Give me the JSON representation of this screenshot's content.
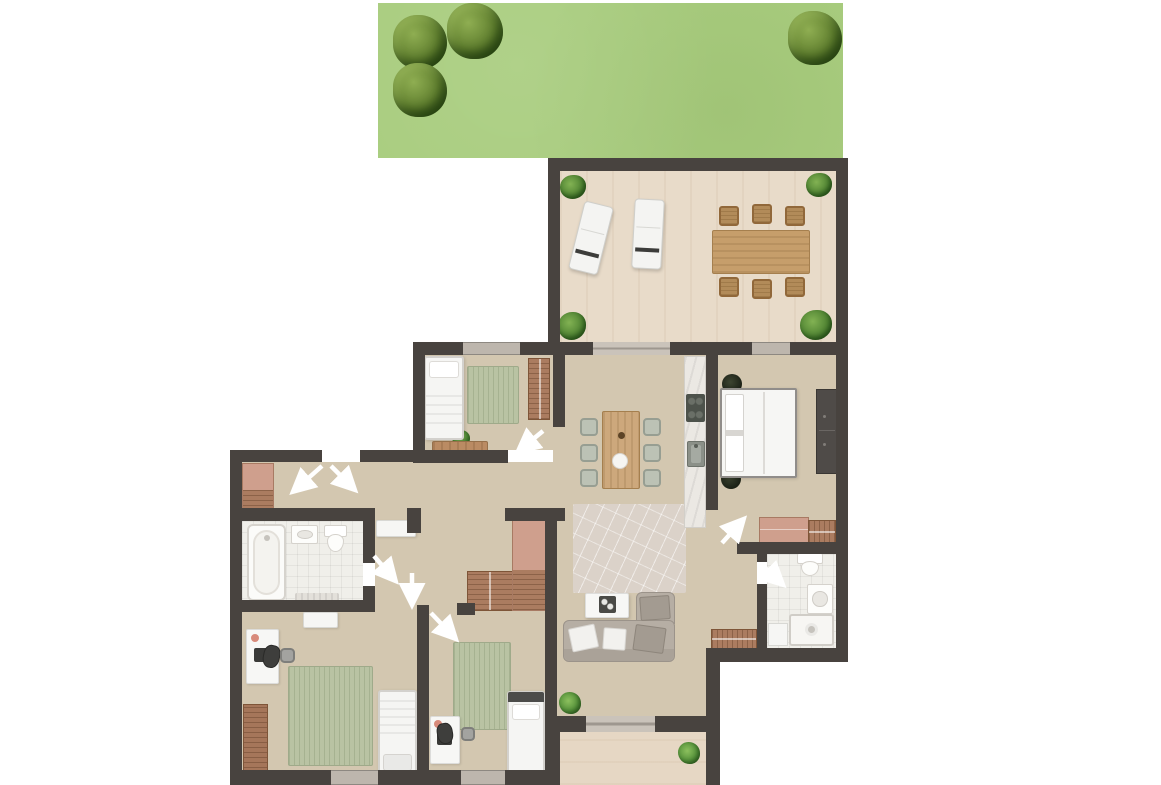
{
  "plan": {
    "canvas": {
      "w": 1161,
      "h": 785
    },
    "palette": {
      "wall": "#48433f",
      "garden_green": "#a9cd7f",
      "floor_wood": "#d3c7b0",
      "terrace_wood": "#e8dbc9",
      "entry_wood": "#e6d7c4",
      "bath_tile": "#f0efea",
      "window_gray": "#bdb6ad",
      "door_gray": "#cac3ba",
      "rug_green": "#b9c3a3",
      "closet_brown": "#ab7c60",
      "closet_salmon": "#cf9f8d",
      "sofa_gray": "#b6aea4",
      "arrow_white": "#ffffff"
    },
    "floors": [
      {
        "t": "garden",
        "n": "garden-lawn",
        "x": 378,
        "y": 3,
        "w": 465,
        "h": 155
      },
      {
        "t": "floor-terrace",
        "n": "terrace-floor",
        "x": 560,
        "y": 171,
        "w": 276,
        "h": 171
      },
      {
        "t": "floor-main",
        "n": "bedroom1-floor",
        "x": 425,
        "y": 355,
        "w": 128,
        "h": 95
      },
      {
        "t": "floor-main",
        "n": "hallway-floor",
        "x": 242,
        "y": 462,
        "w": 311,
        "h": 46
      },
      {
        "t": "floor-main",
        "n": "hall-center-floor",
        "x": 375,
        "y": 508,
        "w": 178,
        "h": 104
      },
      {
        "t": "floor-main",
        "n": "bedrooms-floor",
        "x": 242,
        "y": 612,
        "w": 303,
        "h": 158
      },
      {
        "t": "floor-main",
        "n": "living-floor",
        "x": 553,
        "y": 355,
        "w": 153,
        "h": 361
      },
      {
        "t": "floor-main",
        "n": "master-bedroom-floor",
        "x": 718,
        "y": 355,
        "w": 118,
        "h": 187
      },
      {
        "t": "floor-main",
        "n": "bath2-hall-floor",
        "x": 706,
        "y": 510,
        "w": 51,
        "h": 138
      },
      {
        "t": "floor-bath",
        "n": "bathroom1-floor",
        "x": 242,
        "y": 521,
        "w": 121,
        "h": 79
      },
      {
        "t": "floor-bath",
        "n": "bathroom2-floor",
        "x": 767,
        "y": 554,
        "w": 69,
        "h": 94
      },
      {
        "t": "floor-entry",
        "n": "entry-terrace-floor",
        "x": 560,
        "y": 732,
        "w": 146,
        "h": 53
      }
    ],
    "walls": [
      [
        548,
        158,
        300,
        13
      ],
      [
        548,
        158,
        12,
        197
      ],
      [
        836,
        158,
        12,
        504
      ],
      [
        413,
        342,
        50,
        13
      ],
      [
        520,
        342,
        73,
        13
      ],
      [
        670,
        342,
        82,
        13
      ],
      [
        790,
        342,
        58,
        13
      ],
      [
        413,
        342,
        12,
        115
      ],
      [
        230,
        450,
        92,
        12
      ],
      [
        360,
        450,
        65,
        12
      ],
      [
        230,
        450,
        12,
        335
      ],
      [
        230,
        770,
        101,
        15
      ],
      [
        378,
        770,
        83,
        15
      ],
      [
        505,
        770,
        52,
        15
      ],
      [
        706,
        648,
        142,
        14
      ],
      [
        706,
        648,
        14,
        137
      ],
      [
        548,
        716,
        38,
        16
      ],
      [
        655,
        716,
        57,
        16
      ],
      [
        548,
        716,
        12,
        69
      ],
      [
        553,
        342,
        12,
        85
      ],
      [
        413,
        450,
        95,
        13
      ],
      [
        230,
        508,
        141,
        13
      ],
      [
        505,
        508,
        60,
        13
      ],
      [
        407,
        508,
        14,
        25
      ],
      [
        363,
        508,
        12,
        55
      ],
      [
        363,
        586,
        12,
        26
      ],
      [
        230,
        600,
        145,
        12
      ],
      [
        417,
        605,
        12,
        165
      ],
      [
        457,
        603,
        18,
        12
      ],
      [
        545,
        508,
        12,
        262
      ],
      [
        706,
        342,
        12,
        168
      ],
      [
        737,
        542,
        111,
        12
      ],
      [
        757,
        554,
        10,
        8
      ],
      [
        757,
        584,
        10,
        64
      ]
    ],
    "openings": [
      {
        "t": "window",
        "n": "bedroom1-window",
        "x": 463,
        "y": 342,
        "w": 57,
        "h": 13
      },
      {
        "t": "slider",
        "n": "terrace-sliding-door",
        "x": 593,
        "y": 342,
        "w": 77,
        "h": 13
      },
      {
        "t": "window",
        "n": "master-bedroom-window",
        "x": 752,
        "y": 342,
        "w": 38,
        "h": 13
      },
      {
        "t": "window",
        "n": "bedroom2-window",
        "x": 331,
        "y": 770,
        "w": 47,
        "h": 15
      },
      {
        "t": "window",
        "n": "bedroom3-window",
        "x": 461,
        "y": 770,
        "w": 44,
        "h": 15
      },
      {
        "t": "slider",
        "n": "entry-sliding-door",
        "x": 586,
        "y": 716,
        "w": 69,
        "h": 16
      }
    ],
    "vegetation": [
      {
        "t": "tree",
        "n": "garden-tree",
        "x": 393,
        "y": 15,
        "w": 54,
        "h": 54
      },
      {
        "t": "tree",
        "n": "garden-tree",
        "x": 447,
        "y": 3,
        "w": 56,
        "h": 56
      },
      {
        "t": "tree",
        "n": "garden-tree",
        "x": 393,
        "y": 63,
        "w": 54,
        "h": 54
      },
      {
        "t": "tree",
        "n": "garden-tree",
        "x": 788,
        "y": 11,
        "w": 54,
        "h": 54
      },
      {
        "t": "shrub",
        "n": "terrace-corner-plant",
        "x": 560,
        "y": 175,
        "w": 26,
        "h": 24
      },
      {
        "t": "shrub",
        "n": "terrace-corner-plant",
        "x": 806,
        "y": 173,
        "w": 26,
        "h": 24
      },
      {
        "t": "shrub",
        "n": "terrace-corner-plant",
        "x": 558,
        "y": 312,
        "w": 28,
        "h": 28
      },
      {
        "t": "shrub",
        "n": "terrace-corner-plant",
        "x": 800,
        "y": 310,
        "w": 32,
        "h": 30
      },
      {
        "t": "plant",
        "n": "bench-plant",
        "x": 452,
        "y": 430,
        "w": 18,
        "h": 16
      },
      {
        "t": "plant",
        "n": "living-plant",
        "x": 559,
        "y": 692,
        "w": 22,
        "h": 22
      },
      {
        "t": "plant",
        "n": "entry-plant",
        "x": 678,
        "y": 742,
        "w": 22,
        "h": 22
      },
      {
        "t": "plant-dark",
        "n": "bedside-plant",
        "x": 722,
        "y": 374,
        "w": 20,
        "h": 20
      },
      {
        "t": "plant-dark",
        "n": "bedside-plant",
        "x": 721,
        "y": 469,
        "w": 20,
        "h": 20
      }
    ],
    "furniture": [
      {
        "t": "lounger",
        "n": "sun-lounger",
        "x": 576,
        "y": 203,
        "w": 30,
        "h": 70,
        "r": 14
      },
      {
        "t": "lounger",
        "n": "sun-lounger",
        "x": 633,
        "y": 199,
        "w": 30,
        "h": 70,
        "r": 3
      },
      {
        "t": "table-wood",
        "n": "terrace-dining-table",
        "x": 712,
        "y": 230,
        "w": 98,
        "h": 44
      },
      {
        "t": "chair-tan",
        "n": "terrace-chair",
        "x": 719,
        "y": 206,
        "w": 20,
        "h": 20
      },
      {
        "t": "chair-tan",
        "n": "terrace-chair",
        "x": 752,
        "y": 204,
        "w": 20,
        "h": 20
      },
      {
        "t": "chair-tan",
        "n": "terrace-chair",
        "x": 785,
        "y": 206,
        "w": 20,
        "h": 20
      },
      {
        "t": "chair-tan",
        "n": "terrace-chair",
        "x": 719,
        "y": 277,
        "w": 20,
        "h": 20
      },
      {
        "t": "chair-tan",
        "n": "terrace-chair",
        "x": 752,
        "y": 279,
        "w": 20,
        "h": 20
      },
      {
        "t": "chair-tan",
        "n": "terrace-chair",
        "x": 785,
        "y": 277,
        "w": 20,
        "h": 20
      },
      {
        "t": "rug-green",
        "n": "bedroom1-rug",
        "x": 467,
        "y": 366,
        "w": 52,
        "h": 58
      },
      {
        "t": "bed bed-n",
        "n": "bedroom1-bed",
        "x": 424,
        "y": 356,
        "w": 40,
        "h": 84
      },
      {
        "t": "closet-striped",
        "n": "bedroom1-wardrobe",
        "x": 528,
        "y": 358,
        "w": 22,
        "h": 62
      },
      {
        "t": "bench-wood",
        "n": "bedroom1-bench",
        "x": 432,
        "y": 441,
        "w": 56,
        "h": 12
      },
      {
        "t": "closet-combo",
        "n": "hallway-wardrobe",
        "x": 242,
        "y": 463,
        "w": 32,
        "h": 49
      },
      {
        "t": "closet-striped",
        "n": "hall-closet",
        "x": 467,
        "y": 571,
        "w": 46,
        "h": 40
      },
      {
        "t": "closet-combo",
        "n": "hall-closet-tall",
        "x": 512,
        "y": 518,
        "w": 40,
        "h": 93
      },
      {
        "t": "bathtub",
        "n": "bathtub",
        "x": 247,
        "y": 524,
        "w": 39,
        "h": 77
      },
      {
        "t": "sink-bath",
        "n": "bathroom1-sink",
        "x": 291,
        "y": 525,
        "w": 27,
        "h": 19
      },
      {
        "t": "toilet",
        "n": "bathroom1-toilet",
        "x": 324,
        "y": 525,
        "w": 23,
        "h": 27
      },
      {
        "t": "bath-mat",
        "n": "bath-mat",
        "x": 295,
        "y": 593,
        "w": 44,
        "h": 11
      },
      {
        "t": "bench-white",
        "n": "hall-bench",
        "x": 376,
        "y": 520,
        "w": 40,
        "h": 17
      },
      {
        "t": "bench-white",
        "n": "bedroom2-bench",
        "x": 303,
        "y": 612,
        "w": 35,
        "h": 16
      },
      {
        "t": "desk",
        "n": "bedroom2-desk",
        "x": 246,
        "y": 629,
        "w": 33,
        "h": 55
      },
      {
        "t": "chair-dark",
        "n": "bedroom2-desk-chair",
        "x": 263,
        "y": 645,
        "w": 17,
        "h": 23,
        "r": 12
      },
      {
        "t": "bin",
        "n": "bedroom2-bin",
        "x": 280,
        "y": 648,
        "w": 15,
        "h": 15
      },
      {
        "t": "rug-green",
        "n": "bedroom2-rug",
        "x": 288,
        "y": 666,
        "w": 85,
        "h": 100
      },
      {
        "t": "dresser-striped",
        "n": "bedroom2-dresser",
        "x": 243,
        "y": 704,
        "w": 25,
        "h": 70
      },
      {
        "t": "bed bed-s",
        "n": "bedroom2-bed",
        "x": 378,
        "y": 690,
        "w": 39,
        "h": 86
      },
      {
        "t": "rug-green",
        "n": "bedroom3-rug",
        "x": 453,
        "y": 642,
        "w": 58,
        "h": 88
      },
      {
        "t": "desk",
        "n": "bedroom3-desk",
        "x": 430,
        "y": 716,
        "w": 30,
        "h": 48
      },
      {
        "t": "chair-dark",
        "n": "bedroom3-desk-chair",
        "x": 437,
        "y": 723,
        "w": 16,
        "h": 21,
        "r": -10
      },
      {
        "t": "bin",
        "n": "bedroom3-bin",
        "x": 461,
        "y": 727,
        "w": 14,
        "h": 14
      },
      {
        "t": "bed bed-head",
        "n": "bedroom3-bed",
        "x": 507,
        "y": 691,
        "w": 38,
        "h": 86
      },
      {
        "t": "counter",
        "n": "kitchen-counter",
        "x": 684,
        "y": 356,
        "w": 22,
        "h": 172
      },
      {
        "t": "cooktop",
        "n": "cooktop",
        "x": 686,
        "y": 394,
        "w": 19,
        "h": 28
      },
      {
        "t": "sink-kitchen",
        "n": "kitchen-sink",
        "x": 687,
        "y": 441,
        "w": 18,
        "h": 26
      },
      {
        "t": "table-wood-v",
        "n": "dining-table",
        "x": 602,
        "y": 411,
        "w": 38,
        "h": 78
      },
      {
        "t": "chair-green",
        "n": "dining-chair",
        "x": 580,
        "y": 418,
        "w": 18,
        "h": 18
      },
      {
        "t": "chair-green",
        "n": "dining-chair",
        "x": 580,
        "y": 444,
        "w": 18,
        "h": 18
      },
      {
        "t": "chair-green",
        "n": "dining-chair",
        "x": 580,
        "y": 469,
        "w": 18,
        "h": 18
      },
      {
        "t": "chair-green",
        "n": "dining-chair",
        "x": 643,
        "y": 418,
        "w": 18,
        "h": 18
      },
      {
        "t": "chair-green",
        "n": "dining-chair",
        "x": 643,
        "y": 444,
        "w": 18,
        "h": 18
      },
      {
        "t": "chair-green",
        "n": "dining-chair",
        "x": 643,
        "y": 469,
        "w": 18,
        "h": 18
      },
      {
        "t": "rug-living",
        "n": "living-rug",
        "x": 573,
        "y": 504,
        "w": 113,
        "h": 89
      },
      {
        "t": "coffee-table",
        "n": "coffee-table",
        "x": 585,
        "y": 593,
        "w": 44,
        "h": 25
      },
      {
        "t": "tray",
        "n": "coffee-table-tray",
        "x": 599,
        "y": 596,
        "w": 17,
        "h": 17
      },
      {
        "t": "sofa-chaise",
        "n": "sofa-chaise",
        "x": 636,
        "y": 592,
        "w": 39,
        "h": 32
      },
      {
        "t": "sofa",
        "n": "sofa",
        "x": 563,
        "y": 620,
        "w": 112,
        "h": 42
      },
      {
        "t": "cushion-gray",
        "n": "sofa-cushion",
        "x": 640,
        "y": 596,
        "w": 30,
        "h": 24,
        "r": -4
      },
      {
        "t": "cushion-white",
        "n": "sofa-cushion",
        "x": 570,
        "y": 626,
        "w": 27,
        "h": 24,
        "r": -12
      },
      {
        "t": "cushion-white",
        "n": "sofa-cushion",
        "x": 603,
        "y": 628,
        "w": 23,
        "h": 22,
        "r": 4
      },
      {
        "t": "cushion-gray",
        "n": "sofa-cushion",
        "x": 634,
        "y": 626,
        "w": 31,
        "h": 26,
        "r": 8
      },
      {
        "t": "bed-double",
        "n": "master-bed",
        "x": 720,
        "y": 388,
        "w": 77,
        "h": 90
      },
      {
        "t": "wardrobe-dark",
        "n": "master-wardrobe",
        "x": 816,
        "y": 389,
        "w": 22,
        "h": 85
      },
      {
        "t": "dresser-salmon",
        "n": "master-dresser",
        "x": 759,
        "y": 517,
        "w": 50,
        "h": 26
      },
      {
        "t": "closet-striped-h",
        "n": "master-dresser-side",
        "x": 808,
        "y": 520,
        "w": 28,
        "h": 23
      },
      {
        "t": "closet-striped-h",
        "n": "hall-sideboard",
        "x": 711,
        "y": 629,
        "w": 46,
        "h": 20
      },
      {
        "t": "toilet",
        "n": "bathroom2-toilet",
        "x": 797,
        "y": 553,
        "w": 26,
        "h": 23
      },
      {
        "t": "sink-bath",
        "n": "bathroom2-sink",
        "x": 807,
        "y": 584,
        "w": 26,
        "h": 30
      },
      {
        "t": "shower",
        "n": "shower",
        "x": 789,
        "y": 614,
        "w": 45,
        "h": 32
      },
      {
        "t": "cabinet-white",
        "n": "bathroom2-cabinet",
        "x": 768,
        "y": 623,
        "w": 20,
        "h": 23
      }
    ],
    "arrows": [
      {
        "n": "door-swing-hallway-left",
        "x1": 322,
        "y1": 466,
        "x2": 296,
        "y2": 489
      },
      {
        "n": "door-swing-hallway-right",
        "x1": 331,
        "y1": 466,
        "x2": 352,
        "y2": 487
      },
      {
        "n": "door-swing-bedroom1",
        "x1": 543,
        "y1": 431,
        "x2": 521,
        "y2": 449
      },
      {
        "n": "door-swing-bathroom1",
        "x1": 374,
        "y1": 556,
        "x2": 393,
        "y2": 578
      },
      {
        "n": "door-swing-bedroom2",
        "x1": 412,
        "y1": 573,
        "x2": 412,
        "y2": 601
      },
      {
        "n": "door-swing-bedroom3",
        "x1": 431,
        "y1": 613,
        "x2": 453,
        "y2": 636
      },
      {
        "n": "door-swing-master-bedroom",
        "x1": 722,
        "y1": 543,
        "x2": 741,
        "y2": 522
      },
      {
        "n": "door-swing-bathroom2",
        "x1": 762,
        "y1": 565,
        "x2": 780,
        "y2": 582
      }
    ]
  }
}
